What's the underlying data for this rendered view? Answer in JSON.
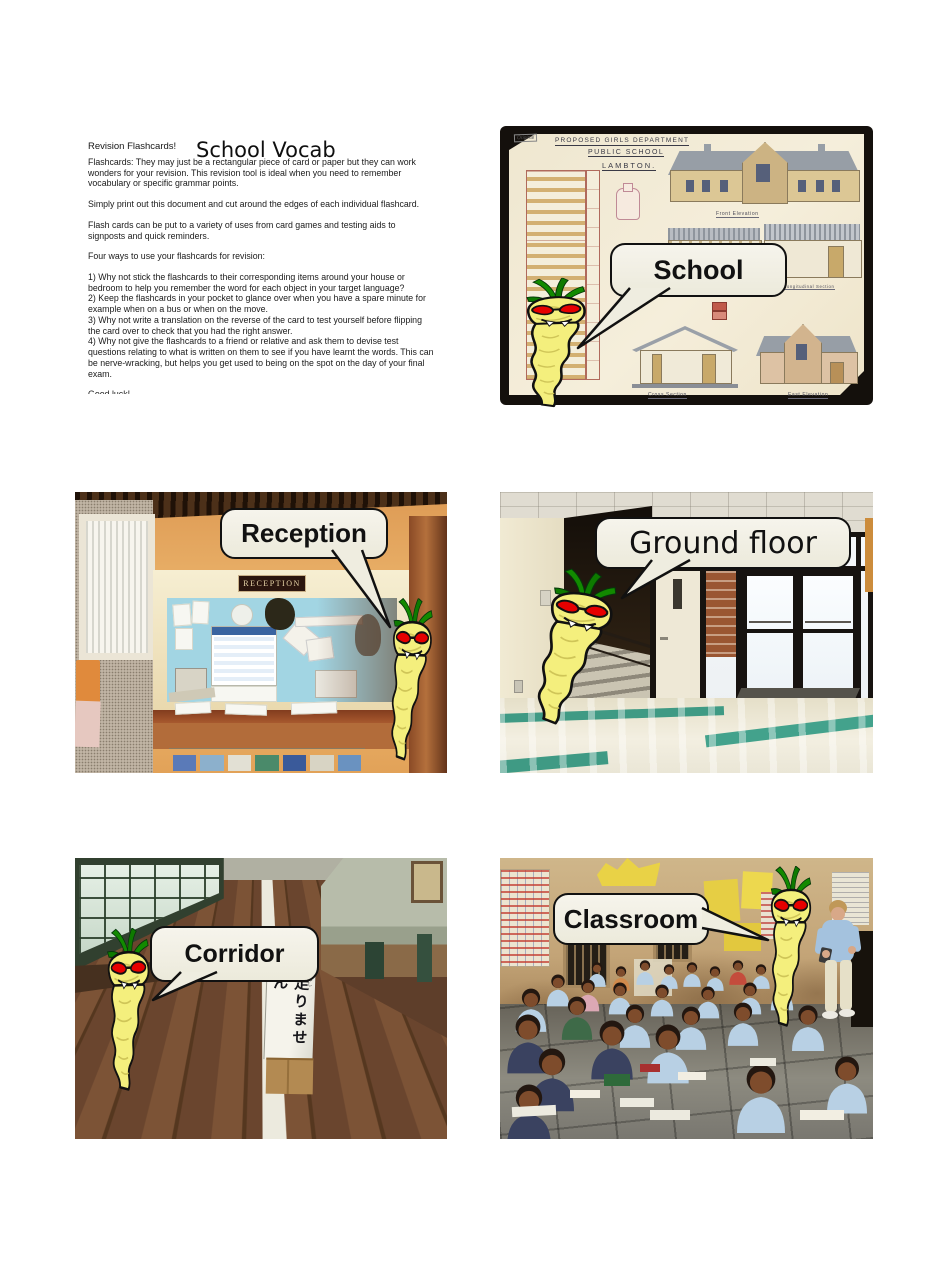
{
  "doc": {
    "label": "Revision Flashcards!",
    "title": "School Vocab",
    "paragraphs": [
      "Flashcards: They may just be a rectangular piece of card or paper but they can work wonders for your revision. This revision tool is ideal when you need to remember vocabulary or specific grammar points.",
      "Simply print out this document and cut around the edges of each individual flashcard.",
      "Flash cards can be put to a variety of uses from card games and testing aids to signposts and quick reminders.",
      "Four ways to use your flashcards for revision:",
      "1) Why not stick the flashcards to their corresponding items around your house or bedroom to help you remember the word for each object in your target language?\n2) Keep the flashcards in your pocket to glance over when you have a spare minute for example when on a bus or when on the move.\n3) Why not write a translation on the reverse of the card to test yourself before flipping the card over to check that you had the right answer.\n4) Why not give the flashcards to a friend or relative and ask them to devise test questions relating to what is written on them to see if you have learnt the words. This can be nerve-wracking, but helps you get used to being on the spot on the day of your final exam.",
      "Good luck!"
    ]
  },
  "cards": [
    {
      "id": "school",
      "label": "School"
    },
    {
      "id": "reception",
      "label": "Reception"
    },
    {
      "id": "ground-floor",
      "label": "Ground floor"
    },
    {
      "id": "corridor",
      "label": "Corridor"
    },
    {
      "id": "classroom",
      "label": "Classroom"
    }
  ],
  "scene_text": {
    "drawing_note": "Original",
    "drawing_line1": "Proposed Girls Department",
    "drawing_line2": "Public School",
    "drawing_line3": "Lambton.",
    "drawing_captions": [
      "Front Elevation",
      "Half Front Elevation",
      "Half Longitudinal Section",
      "Cross Section",
      "East Elevation"
    ],
    "reception_sign": "RECEPTION",
    "corridor_sign": "走りません",
    "corridor_sign_furigana": "はし"
  },
  "colors": {
    "parsnip_body": "#f4ef7d",
    "parsnip_leaves": "#128a00",
    "parsnip_eyes": "#e60000",
    "bubble_fill": "#efede0",
    "bubble_border": "#111111",
    "page_background": "#ffffff"
  }
}
